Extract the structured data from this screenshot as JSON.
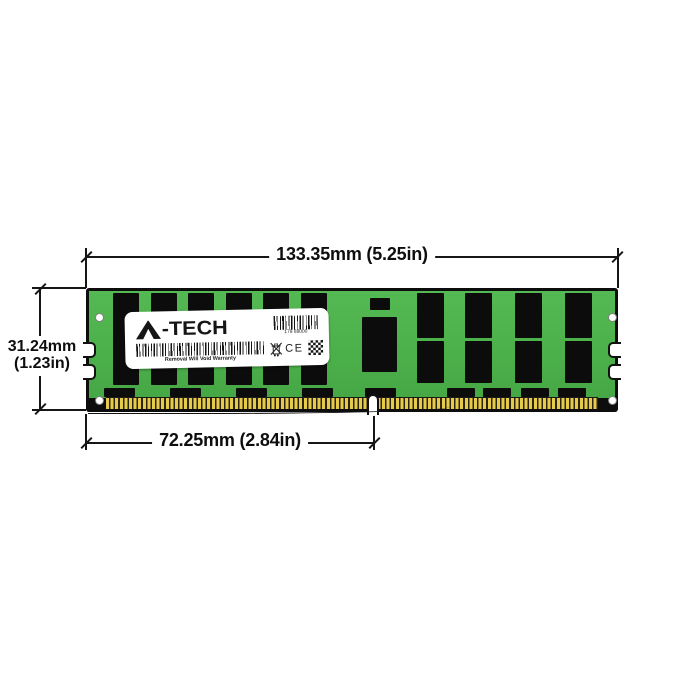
{
  "diagram": {
    "type": "memory-module-dimension-drawing",
    "dimensions": {
      "width_label": "133.35mm (5.25in)",
      "height_mm": "31.24mm",
      "height_in": "(1.23in)",
      "notch_offset_label": "72.25mm (2.84in)"
    },
    "module": {
      "brand": "A-TECH",
      "brand_suffix": "-TECH",
      "label": {
        "serial": "179 88000",
        "warranty": "Removal Will Void Warranty",
        "ce_mark": "CE"
      },
      "colors": {
        "pcb_green": "#4cb04a",
        "chip_black": "#0c0c0c",
        "pin_gold": "#e6cb4b",
        "outline": "#0d0d0d"
      }
    }
  }
}
